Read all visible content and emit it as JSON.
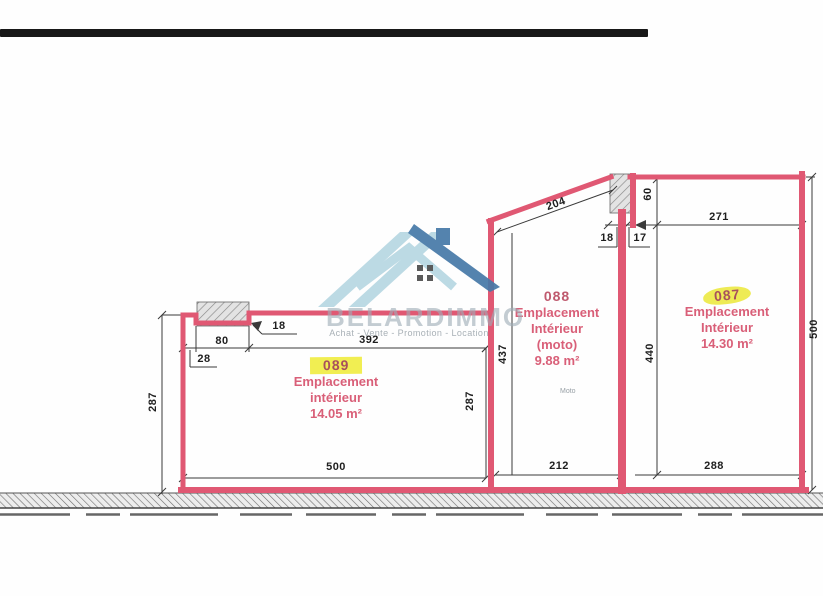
{
  "scan": {
    "top_bar_color": "#181818"
  },
  "watermark": {
    "brand": "BELARDIMMO",
    "tagline": "Achat - Vente - Promotion - Location",
    "logo_light": "#b7d7e2",
    "logo_dark": "#4679a8"
  },
  "colors": {
    "outline_pink": "#e05873",
    "dimension_text": "#1e1e1e",
    "label_pink": "#d95f78",
    "number_maroon": "#a8505c",
    "highlight_yellow": "#f1ee52"
  },
  "parcels": [
    {
      "number": "089",
      "line1": "Emplacement",
      "line2": "intérieur",
      "area": "14.05  m²",
      "highlighted": true
    },
    {
      "number": "088",
      "line1": "Emplacement",
      "line2": "Intérieur",
      "line3": "(moto)",
      "area": "9.88 m²",
      "note": "Moto",
      "highlighted": false
    },
    {
      "number": "087",
      "line1": "Emplacement",
      "line2": "Intérieur",
      "area": "14.30 m²",
      "highlighted": true
    }
  ],
  "dimensions": {
    "p089_left_height": "287",
    "p089_notch_width": "80",
    "p089_notch_offset": "28",
    "p089_notch_depth": "18",
    "p089_top_width": "392",
    "p089_right_height": "287",
    "p089_bottom_width": "500",
    "p088_top_width": "204",
    "p088_left_height": "437",
    "p088_bottom_width": "212",
    "wall_thickness": "18",
    "wall_gap": "17",
    "p087_top_offset": "60",
    "p087_top_width": "271",
    "p087_left_height": "440",
    "p087_bottom_width": "288",
    "p087_right_height": "500"
  }
}
